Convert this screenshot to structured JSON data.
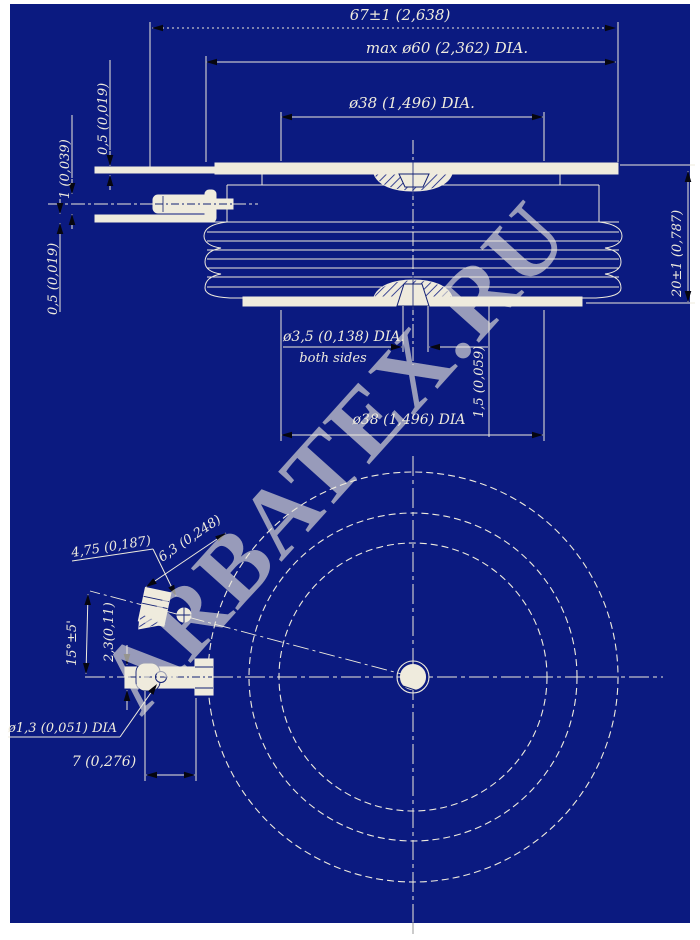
{
  "drawing": {
    "watermark": "ARBATEX.RU",
    "colors": {
      "background": "#0b1a80",
      "line": "#efebdd",
      "arrow": "#06060f",
      "watermark": "#d01050",
      "inner_line": "#122074"
    },
    "side_view": {
      "dim_total_width": "67±1 (2,638)",
      "dim_max_diameter": "max ø60 (2,362) DIA.",
      "dim_pole_diameter_top": "ø38 (1,496) DIA.",
      "dim_lead_thickness_top": "0,5 (0,019)",
      "dim_gate_lead_thickness": "1 (0,039)",
      "dim_lead_thickness_bottom": "0,5 (0,019)",
      "dim_height": "20±1 (0,787)",
      "dim_center_hole": "ø3,5 (0,138) DIA.",
      "dim_center_hole_note": "both sides",
      "dim_hole_depth": "1,5 (0,059)",
      "dim_pole_diameter_bottom": "ø38 (1,496) DIA"
    },
    "bottom_view": {
      "dim_lug_width": "4,75 (0,187)",
      "dim_hole_offset": "6,3 (0,248)",
      "dim_lug_angle": "15°±5'",
      "dim_lug_thickness": "2,3(0,11)",
      "dim_gate_hole_diameter": "ø1,3 (0,051) DIA",
      "dim_lug_length": "7 (0,276)"
    }
  }
}
